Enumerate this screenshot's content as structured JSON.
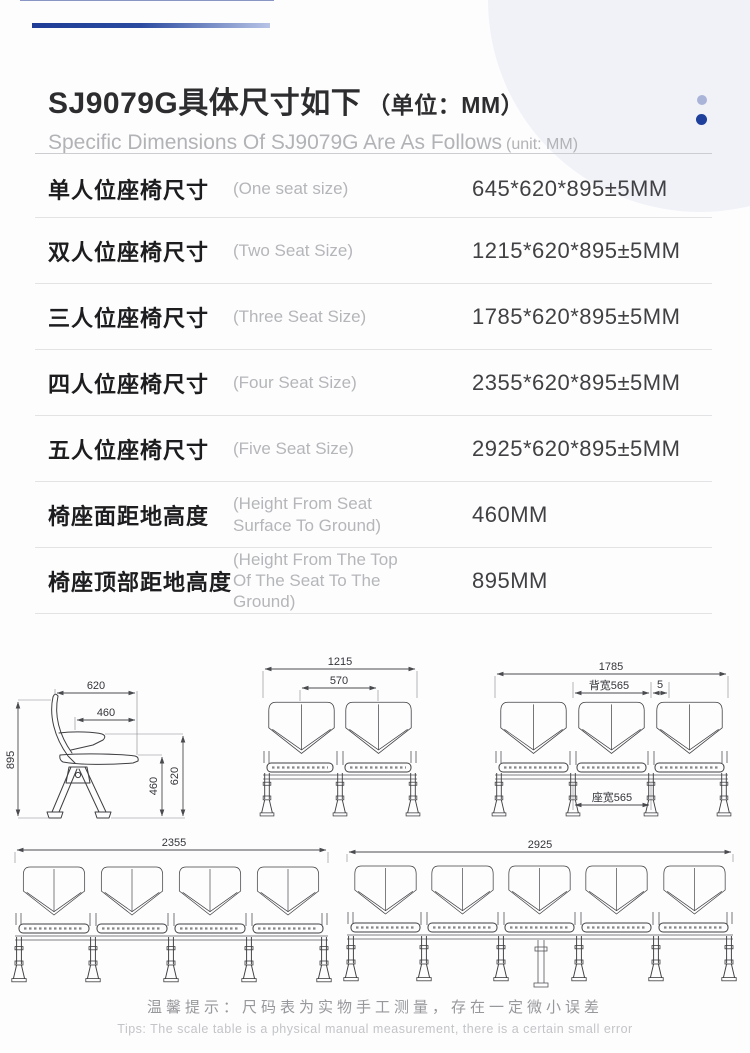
{
  "header": {
    "title_cn": "SJ9079G具体尺寸如下",
    "title_unit": "（单位：MM）",
    "subtitle_en": "Specific Dimensions Of SJ9079G Are As Follows",
    "subtitle_unit": "(unit: MM)"
  },
  "spec_table": {
    "rows": [
      {
        "label_cn": "单人位座椅尺寸",
        "label_en": "(One seat size)",
        "value": "645*620*895±5MM"
      },
      {
        "label_cn": "双人位座椅尺寸",
        "label_en": "(Two Seat Size)",
        "value": "1215*620*895±5MM"
      },
      {
        "label_cn": "三人位座椅尺寸",
        "label_en": "(Three Seat Size)",
        "value": "1785*620*895±5MM"
      },
      {
        "label_cn": "四人位座椅尺寸",
        "label_en": "(Four Seat Size)",
        "value": "2355*620*895±5MM"
      },
      {
        "label_cn": "五人位座椅尺寸",
        "label_en": "(Five Seat Size)",
        "value": "2925*620*895±5MM"
      },
      {
        "label_cn": "椅座面距地高度",
        "label_en": "(Height From Seat Surface To Ground)",
        "value": "460MM"
      },
      {
        "label_cn": "椅座顶部距地高度",
        "label_en": "(Height From The Top Of The Seat To The Ground)",
        "value": "895MM"
      }
    ]
  },
  "drawings": {
    "side_view": {
      "back_depth_top": "620",
      "seat_depth": "460",
      "total_height": "895",
      "seat_height": "460",
      "back_height": "620"
    },
    "two_seat_front": {
      "total_width": "1215",
      "seat_pitch": "570"
    },
    "three_seat_front": {
      "total_width": "1785",
      "back_width": "背宽565",
      "gap": "5",
      "seat_width": "座宽565"
    },
    "four_seat_front": {
      "total_width": "2355"
    },
    "five_seat_front": {
      "total_width": "2925"
    }
  },
  "footer": {
    "tip_cn": "温馨提示：尺码表为实物手工测量，存在一定微小误差",
    "tip_en": "Tips: The scale table is a physical manual measurement, there is a certain small error"
  },
  "colors": {
    "accent_blue": "#1f3d96",
    "dot_light_blue": "#a9b4d8",
    "dot_dark_blue": "#1e3f9b",
    "circle_bg": "#f0f2f7"
  }
}
